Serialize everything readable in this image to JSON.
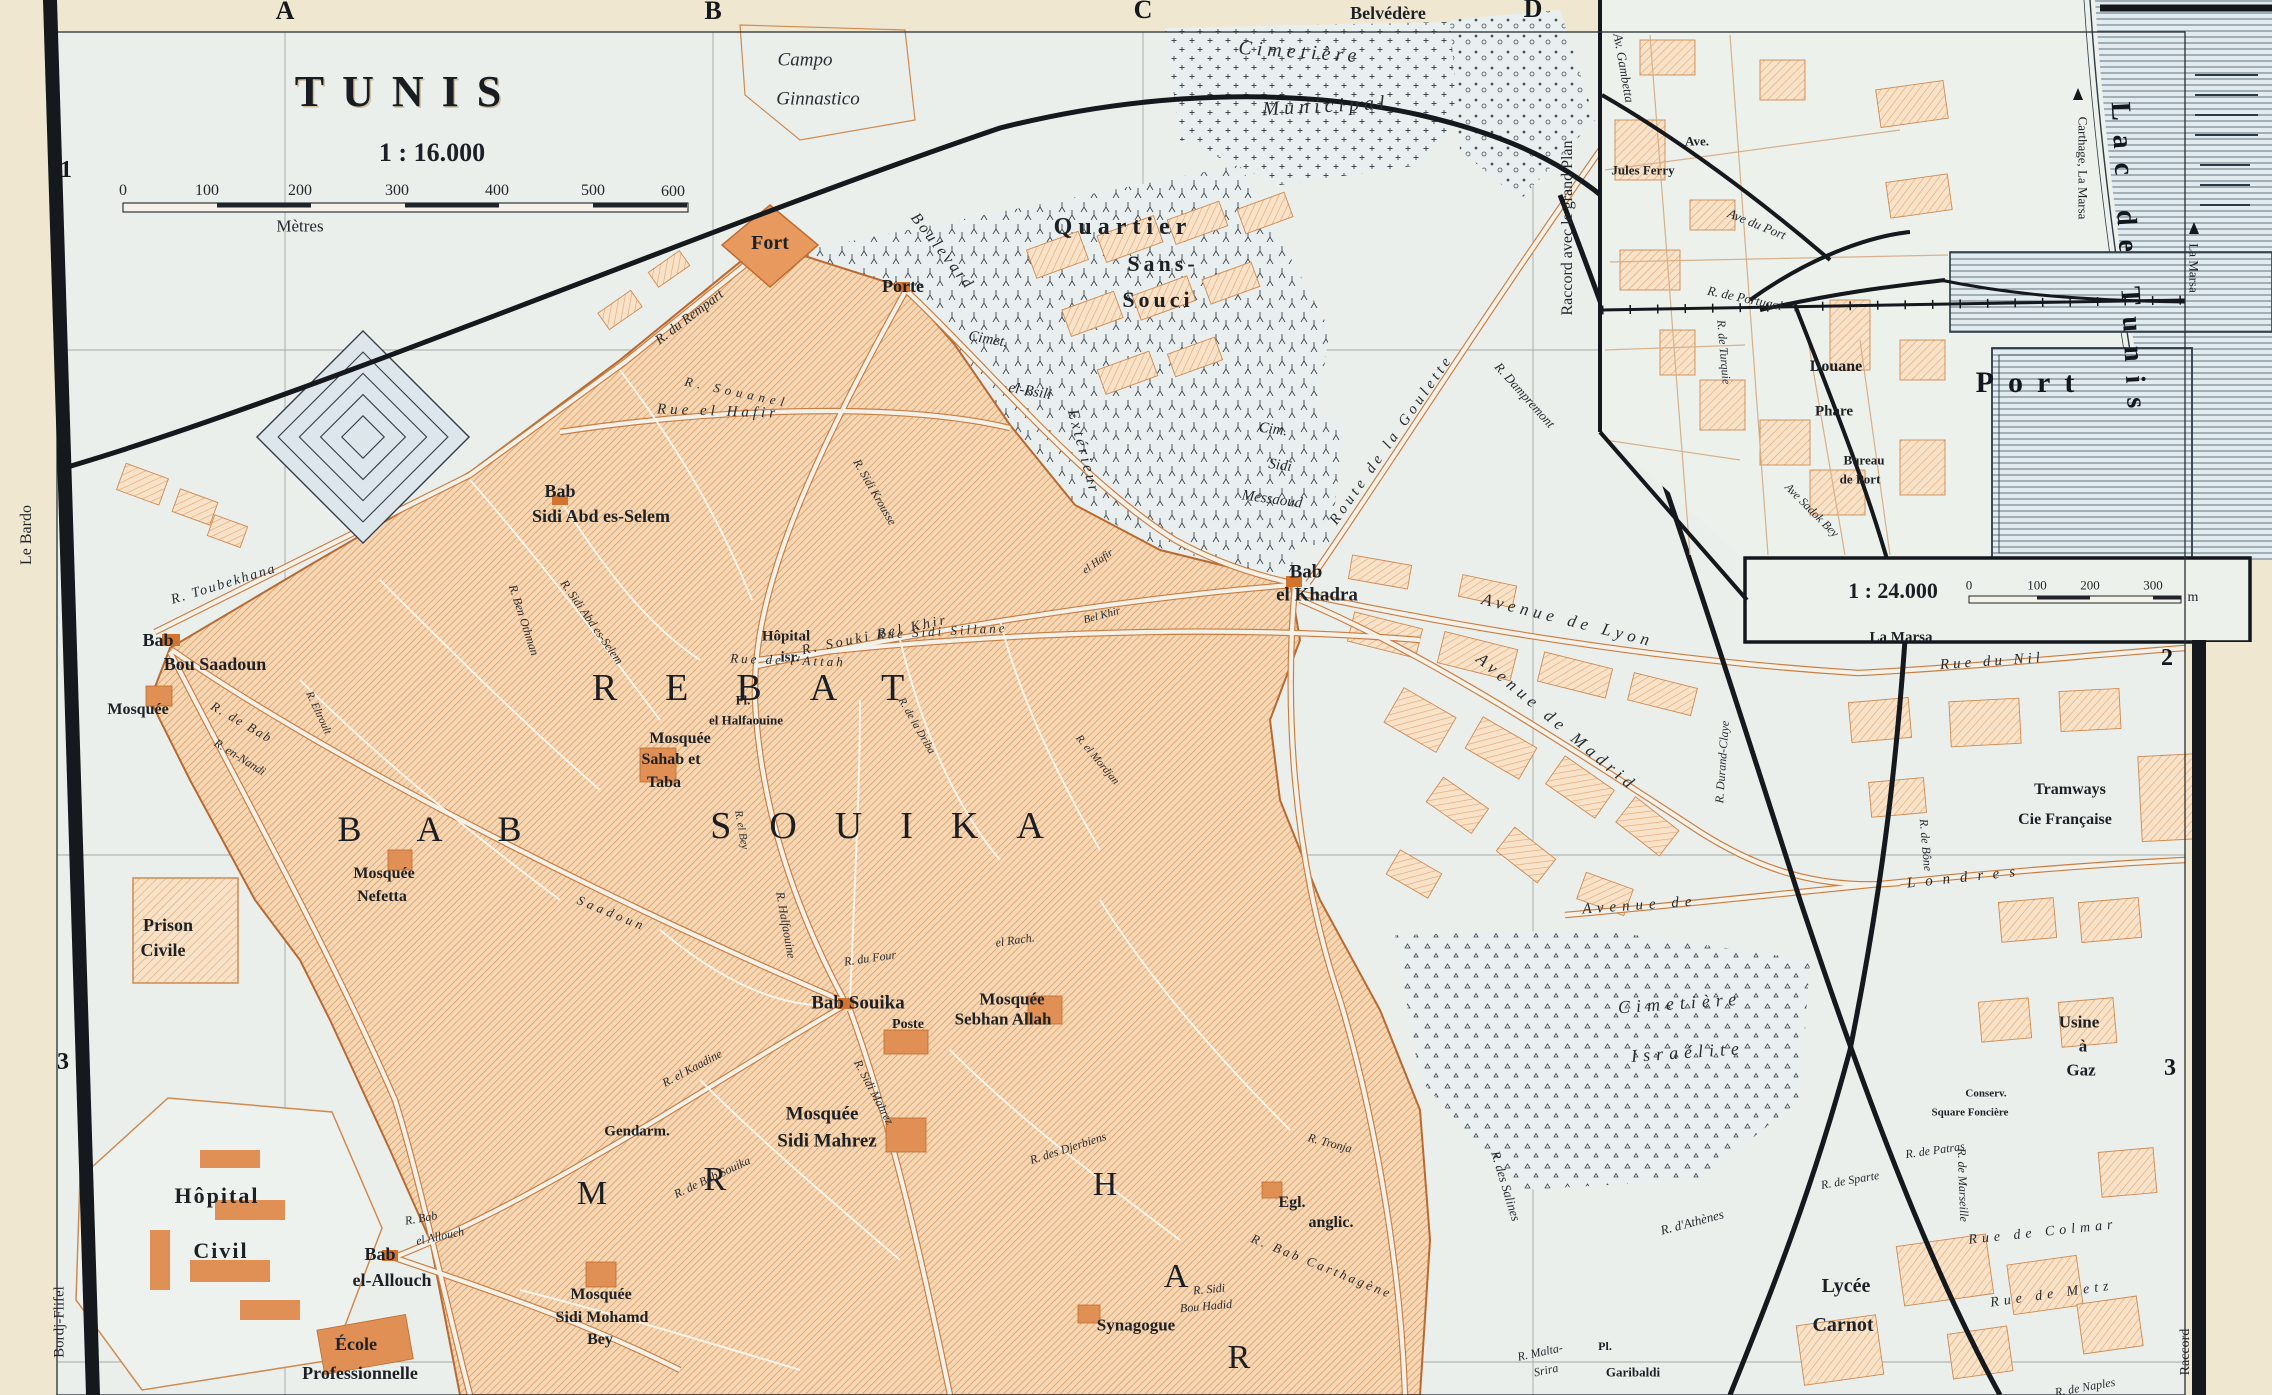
{
  "map": {
    "name": "Plan of Tunis (Baedeker style city map)",
    "main_scale": "1 : 16.000",
    "main_scale_unit": "Mètres",
    "inset_scale": "1 : 24.000",
    "inset_scale_unit": "m"
  },
  "colors": {
    "paper": "#f0e7d1",
    "map_background": "#ebefec",
    "built_area": "#f5d7b4",
    "built_hatch": "#dd9560",
    "building_solid": "#e09055",
    "road_casing": "#c97d42",
    "ink": "#1c2025",
    "water_line": "#2c3a46",
    "water_fill": "#e2ebee"
  },
  "grid": {
    "columns": [
      "A",
      "B",
      "C",
      "D"
    ],
    "rows_left": [
      "1",
      "2",
      "3"
    ],
    "rows_right": [
      "2",
      "3"
    ]
  },
  "labels": [
    {
      "t": "A",
      "x": 285,
      "y": 11,
      "s": 26,
      "c": "grid"
    },
    {
      "t": "B",
      "x": 713,
      "y": 11,
      "s": 26,
      "c": "grid"
    },
    {
      "t": "C",
      "x": 1143,
      "y": 10,
      "s": 26,
      "c": "grid"
    },
    {
      "t": "D",
      "x": 1533,
      "y": 9,
      "s": 26,
      "c": "grid"
    },
    {
      "t": "1",
      "x": 66,
      "y": 170,
      "s": 24,
      "c": "grid"
    },
    {
      "t": "2",
      "x": 70,
      "y": 637,
      "s": 24,
      "c": "grid"
    },
    {
      "t": "3",
      "x": 63,
      "y": 1062,
      "s": 24,
      "c": "grid"
    },
    {
      "t": "2",
      "x": 2167,
      "y": 658,
      "s": 24,
      "c": "grid"
    },
    {
      "t": "3",
      "x": 2170,
      "y": 1068,
      "s": 24,
      "c": "grid"
    },
    {
      "t": "Le Bardo",
      "x": 27,
      "y": 535,
      "r": -90,
      "s": 16,
      "c": "margin"
    },
    {
      "t": "Bordj-Flifel",
      "x": 60,
      "y": 1322,
      "r": -90,
      "s": 15,
      "c": "margin"
    },
    {
      "t": "TUNIS",
      "x": 407,
      "y": 92,
      "s": 44,
      "c": "title",
      "ls": 18
    },
    {
      "t": "1 : 16.000",
      "x": 432,
      "y": 153,
      "s": 26,
      "c": "sub"
    },
    {
      "t": "0",
      "x": 123,
      "y": 191,
      "s": 16,
      "c": "num"
    },
    {
      "t": "100",
      "x": 207,
      "y": 191,
      "s": 16,
      "c": "num"
    },
    {
      "t": "200",
      "x": 300,
      "y": 191,
      "s": 16,
      "c": "num"
    },
    {
      "t": "300",
      "x": 397,
      "y": 191,
      "s": 16,
      "c": "num"
    },
    {
      "t": "400",
      "x": 497,
      "y": 191,
      "s": 16,
      "c": "num"
    },
    {
      "t": "500",
      "x": 593,
      "y": 191,
      "s": 16,
      "c": "num"
    },
    {
      "t": "600",
      "x": 673,
      "y": 192,
      "s": 16,
      "c": "num"
    },
    {
      "t": "Mètres",
      "x": 300,
      "y": 226,
      "s": 17,
      "c": "num"
    },
    {
      "t": "Campo",
      "x": 805,
      "y": 60,
      "s": 19,
      "c": "ital"
    },
    {
      "t": "Ginnastico",
      "x": 818,
      "y": 99,
      "s": 19,
      "c": "ital"
    },
    {
      "t": "Fort",
      "x": 770,
      "y": 243,
      "s": 20,
      "c": "place"
    },
    {
      "t": "Porte",
      "x": 903,
      "y": 286,
      "s": 18,
      "c": "place"
    },
    {
      "t": "Quartier",
      "x": 1123,
      "y": 227,
      "s": 24,
      "c": "place",
      "ls": 6
    },
    {
      "t": "Sans-",
      "x": 1163,
      "y": 264,
      "s": 22,
      "c": "place",
      "ls": 4
    },
    {
      "t": "Souci",
      "x": 1158,
      "y": 300,
      "s": 22,
      "c": "place",
      "ls": 4
    },
    {
      "t": "Boulevard",
      "x": 942,
      "y": 252,
      "r": 52,
      "s": 16,
      "c": "street",
      "ls": 3
    },
    {
      "t": "Extérieur",
      "x": 1083,
      "y": 452,
      "r": 75,
      "s": 16,
      "c": "street",
      "ls": 3
    },
    {
      "t": "Cimet.",
      "x": 988,
      "y": 340,
      "r": 10,
      "s": 15,
      "c": "street"
    },
    {
      "t": "el-Bsili",
      "x": 1030,
      "y": 392,
      "r": 10,
      "s": 15,
      "c": "street"
    },
    {
      "t": "Cimetière",
      "x": 1300,
      "y": 52,
      "r": 4,
      "s": 20,
      "c": "ital",
      "ls": 5
    },
    {
      "t": "Municipal",
      "x": 1326,
      "y": 106,
      "r": -3,
      "s": 20,
      "c": "ital",
      "ls": 5
    },
    {
      "t": "Belvédère",
      "x": 1388,
      "y": 13,
      "s": 18,
      "c": "place"
    },
    {
      "t": "Cim.",
      "x": 1273,
      "y": 430,
      "r": 8,
      "s": 15,
      "c": "street"
    },
    {
      "t": "Sidi",
      "x": 1280,
      "y": 466,
      "r": 8,
      "s": 15,
      "c": "street"
    },
    {
      "t": "Messaoud",
      "x": 1272,
      "y": 500,
      "r": 8,
      "s": 15,
      "c": "street"
    },
    {
      "t": "Route de la Goulette",
      "x": 1392,
      "y": 440,
      "r": -55,
      "s": 15,
      "c": "street",
      "ls": 4
    },
    {
      "t": "R. Dampremont",
      "x": 1525,
      "y": 395,
      "r": 48,
      "s": 13,
      "c": "street"
    },
    {
      "t": "Raccord avec le grand Plan",
      "x": 1568,
      "y": 228,
      "r": -90,
      "s": 16,
      "c": "margin"
    },
    {
      "t": "R. du Rempart",
      "x": 690,
      "y": 318,
      "r": -37,
      "s": 14,
      "c": "street"
    },
    {
      "t": "R. Souanel",
      "x": 737,
      "y": 392,
      "r": 12,
      "s": 13,
      "c": "street",
      "ls": 5
    },
    {
      "t": "Bab",
      "x": 560,
      "y": 491,
      "s": 18,
      "c": "place"
    },
    {
      "t": "Sidi Abd es-Selem",
      "x": 601,
      "y": 516,
      "s": 18,
      "c": "place"
    },
    {
      "t": "Bab",
      "x": 158,
      "y": 640,
      "s": 18,
      "c": "place"
    },
    {
      "t": "Bou Saadoun",
      "x": 215,
      "y": 664,
      "s": 18,
      "c": "place"
    },
    {
      "t": "Mosquée",
      "x": 138,
      "y": 710,
      "s": 16,
      "c": "place"
    },
    {
      "t": "R. Toubekhana",
      "x": 224,
      "y": 585,
      "r": -17,
      "s": 14,
      "c": "street",
      "ls": 2
    },
    {
      "t": "R. de Bab",
      "x": 242,
      "y": 722,
      "r": 30,
      "s": 13,
      "c": "street",
      "ls": 2
    },
    {
      "t": "Saadoun",
      "x": 612,
      "y": 913,
      "r": 22,
      "s": 13,
      "c": "street",
      "ls": 4
    },
    {
      "t": "R. Ben Othman",
      "x": 524,
      "y": 620,
      "r": 72,
      "s": 12,
      "c": "street"
    },
    {
      "t": "R. Sidi Abd es-Selem",
      "x": 592,
      "y": 622,
      "r": 55,
      "s": 12,
      "c": "street"
    },
    {
      "t": "R. en-Nandi",
      "x": 240,
      "y": 757,
      "r": 32,
      "s": 12,
      "c": "street"
    },
    {
      "t": "R. Eltroult",
      "x": 318,
      "y": 713,
      "r": 65,
      "s": 11,
      "c": "street"
    },
    {
      "t": "Rue el Hafir",
      "x": 718,
      "y": 412,
      "r": 2,
      "s": 15,
      "c": "street",
      "ls": 4
    },
    {
      "t": "R. Souki Bel Khir",
      "x": 875,
      "y": 636,
      "r": -12,
      "s": 14,
      "c": "street",
      "ls": 3
    },
    {
      "t": "el Hafir",
      "x": 1098,
      "y": 562,
      "r": -35,
      "s": 11,
      "c": "street"
    },
    {
      "t": "Bel Khir",
      "x": 1102,
      "y": 616,
      "r": -15,
      "s": 11,
      "c": "street"
    },
    {
      "t": "R. Sidi Krousse",
      "x": 875,
      "y": 492,
      "r": 60,
      "s": 12,
      "c": "street"
    },
    {
      "t": "Hôpital",
      "x": 786,
      "y": 637,
      "s": 15,
      "c": "place"
    },
    {
      "t": "isr.",
      "x": 790,
      "y": 658,
      "s": 15,
      "c": "place"
    },
    {
      "t": "Pl.",
      "x": 743,
      "y": 700,
      "s": 13,
      "c": "place"
    },
    {
      "t": "el Halfaouine",
      "x": 746,
      "y": 720,
      "s": 13,
      "c": "place"
    },
    {
      "t": "Mosquée",
      "x": 680,
      "y": 739,
      "s": 16,
      "c": "place"
    },
    {
      "t": "Sahab et",
      "x": 671,
      "y": 760,
      "s": 16,
      "c": "place"
    },
    {
      "t": "Taba",
      "x": 664,
      "y": 783,
      "s": 16,
      "c": "place"
    },
    {
      "t": "R. el Bey",
      "x": 741,
      "y": 830,
      "r": 80,
      "s": 11,
      "c": "street"
    },
    {
      "t": "R. de la Driba",
      "x": 916,
      "y": 726,
      "r": 60,
      "s": 11,
      "c": "street"
    },
    {
      "t": "R. el Mordjan",
      "x": 1097,
      "y": 760,
      "r": 50,
      "s": 11,
      "c": "street"
    },
    {
      "t": "Mosquée",
      "x": 384,
      "y": 874,
      "s": 16,
      "c": "place"
    },
    {
      "t": "Nefetta",
      "x": 382,
      "y": 897,
      "s": 16,
      "c": "place"
    },
    {
      "t": "REBAT",
      "x": 772,
      "y": 688,
      "s": 38,
      "c": "dist",
      "ls": 48
    },
    {
      "t": "BAB",
      "x": 457,
      "y": 829,
      "s": 36,
      "c": "dist",
      "ls": 55
    },
    {
      "t": "SOUIKA",
      "x": 896,
      "y": 826,
      "s": 38,
      "c": "dist",
      "ls": 38
    },
    {
      "t": "H",
      "x": 1105,
      "y": 1185,
      "s": 34,
      "c": "dist"
    },
    {
      "t": "A",
      "x": 1176,
      "y": 1277,
      "s": 34,
      "c": "dist"
    },
    {
      "t": "R",
      "x": 1239,
      "y": 1358,
      "s": 34,
      "c": "dist"
    },
    {
      "t": "M",
      "x": 592,
      "y": 1194,
      "s": 34,
      "c": "dist"
    },
    {
      "t": "R",
      "x": 715,
      "y": 1180,
      "s": 34,
      "c": "dist"
    },
    {
      "t": "Bab Souika",
      "x": 858,
      "y": 1003,
      "s": 19,
      "c": "place"
    },
    {
      "t": "Poste",
      "x": 908,
      "y": 1025,
      "s": 14,
      "c": "place"
    },
    {
      "t": "Mosquée",
      "x": 1012,
      "y": 999,
      "s": 17,
      "c": "place"
    },
    {
      "t": "Sebhan Allah",
      "x": 1003,
      "y": 1019,
      "s": 17,
      "c": "place"
    },
    {
      "t": "Gendarm.",
      "x": 637,
      "y": 1132,
      "s": 15,
      "c": "place"
    },
    {
      "t": "Mosquée",
      "x": 822,
      "y": 1114,
      "s": 19,
      "c": "place"
    },
    {
      "t": "Sidi Mahrez",
      "x": 827,
      "y": 1141,
      "s": 19,
      "c": "place"
    },
    {
      "t": "R. Sidi Mahrez",
      "x": 874,
      "y": 1092,
      "r": 62,
      "s": 12,
      "c": "street"
    },
    {
      "t": "R. el Kaadine",
      "x": 692,
      "y": 1068,
      "r": -28,
      "s": 12,
      "c": "street"
    },
    {
      "t": "R. de Bab Souika",
      "x": 712,
      "y": 1177,
      "r": -25,
      "s": 12,
      "c": "street"
    },
    {
      "t": "R. Halfaouine",
      "x": 786,
      "y": 925,
      "r": 80,
      "s": 12,
      "c": "street"
    },
    {
      "t": "R. du Four",
      "x": 870,
      "y": 958,
      "r": -8,
      "s": 12,
      "c": "street"
    },
    {
      "t": "el Rach.",
      "x": 1015,
      "y": 940,
      "r": -8,
      "s": 12,
      "c": "street"
    },
    {
      "t": "Prison",
      "x": 168,
      "y": 925,
      "s": 18,
      "c": "place"
    },
    {
      "t": "Civile",
      "x": 163,
      "y": 950,
      "s": 18,
      "c": "place"
    },
    {
      "t": "Hôpital",
      "x": 217,
      "y": 1196,
      "s": 22,
      "c": "place",
      "ls": 2
    },
    {
      "t": "Civil",
      "x": 221,
      "y": 1251,
      "s": 22,
      "c": "place",
      "ls": 2
    },
    {
      "t": "Bab",
      "x": 380,
      "y": 1254,
      "s": 18,
      "c": "place"
    },
    {
      "t": "el-Allouch",
      "x": 392,
      "y": 1280,
      "s": 18,
      "c": "place"
    },
    {
      "t": "R. Bab",
      "x": 421,
      "y": 1218,
      "r": -10,
      "s": 12,
      "c": "street"
    },
    {
      "t": "el Allouch",
      "x": 440,
      "y": 1236,
      "r": -12,
      "s": 12,
      "c": "street"
    },
    {
      "t": "École",
      "x": 356,
      "y": 1344,
      "s": 18,
      "c": "place"
    },
    {
      "t": "Professionnelle",
      "x": 360,
      "y": 1373,
      "s": 18,
      "c": "place"
    },
    {
      "t": "Mosquée",
      "x": 601,
      "y": 1295,
      "s": 16,
      "c": "place"
    },
    {
      "t": "Sidi Mohamd",
      "x": 602,
      "y": 1318,
      "s": 16,
      "c": "place"
    },
    {
      "t": "Bey",
      "x": 600,
      "y": 1340,
      "s": 16,
      "c": "place"
    },
    {
      "t": "Synagogue",
      "x": 1136,
      "y": 1325,
      "s": 17,
      "c": "place"
    },
    {
      "t": "R. Sidi",
      "x": 1209,
      "y": 1289,
      "r": -5,
      "s": 12,
      "c": "street"
    },
    {
      "t": "Bou Hadid",
      "x": 1206,
      "y": 1306,
      "r": -5,
      "s": 12,
      "c": "street"
    },
    {
      "t": "Egl.",
      "x": 1292,
      "y": 1203,
      "s": 16,
      "c": "place"
    },
    {
      "t": "anglic.",
      "x": 1331,
      "y": 1223,
      "s": 16,
      "c": "place"
    },
    {
      "t": "R. des Djerbiens",
      "x": 1068,
      "y": 1148,
      "r": -18,
      "s": 12,
      "c": "street"
    },
    {
      "t": "R. Bab Carthagène",
      "x": 1322,
      "y": 1266,
      "r": 22,
      "s": 13,
      "c": "street",
      "ls": 3
    },
    {
      "t": "R. Tronja",
      "x": 1330,
      "y": 1143,
      "r": 15,
      "s": 12,
      "c": "street"
    },
    {
      "t": "R. des Salines",
      "x": 1506,
      "y": 1186,
      "r": 73,
      "s": 13,
      "c": "street"
    },
    {
      "t": "R. Malta-",
      "x": 1540,
      "y": 1352,
      "r": -12,
      "s": 12,
      "c": "street"
    },
    {
      "t": "Srira",
      "x": 1546,
      "y": 1370,
      "r": -12,
      "s": 12,
      "c": "street"
    },
    {
      "t": "Pl.",
      "x": 1605,
      "y": 1346,
      "s": 12,
      "c": "place"
    },
    {
      "t": "Garibaldi",
      "x": 1633,
      "y": 1372,
      "s": 13,
      "c": "place"
    },
    {
      "t": "R. d'Athènes",
      "x": 1692,
      "y": 1222,
      "r": -15,
      "s": 13,
      "c": "street"
    },
    {
      "t": "Bab",
      "x": 1306,
      "y": 572,
      "s": 19,
      "c": "place"
    },
    {
      "t": "el Khadra",
      "x": 1317,
      "y": 595,
      "s": 19,
      "c": "place"
    },
    {
      "t": "Avenue de Lyon",
      "x": 1568,
      "y": 620,
      "r": 14,
      "s": 17,
      "c": "street",
      "ls": 5
    },
    {
      "t": "Avenue de Madrid",
      "x": 1557,
      "y": 722,
      "r": 40,
      "s": 17,
      "c": "street",
      "ls": 5
    },
    {
      "t": "R. Durand-Claye",
      "x": 1722,
      "y": 762,
      "r": -86,
      "s": 12,
      "c": "street"
    },
    {
      "t": "Rue Sidi Sillane",
      "x": 942,
      "y": 631,
      "r": -3,
      "s": 13,
      "c": "street",
      "ls": 3
    },
    {
      "t": "Rue de l'Attah",
      "x": 788,
      "y": 660,
      "r": 2,
      "s": 13,
      "c": "street",
      "ls": 3
    },
    {
      "t": "Avenue de",
      "x": 1640,
      "y": 906,
      "r": -4,
      "s": 15,
      "c": "street",
      "ls": 6
    },
    {
      "t": "Londres",
      "x": 1966,
      "y": 878,
      "r": -6,
      "s": 15,
      "c": "street",
      "ls": 10
    },
    {
      "t": "Cimetière",
      "x": 1680,
      "y": 1003,
      "r": -4,
      "s": 18,
      "c": "ital",
      "ls": 6
    },
    {
      "t": "Israélite",
      "x": 1688,
      "y": 1052,
      "r": -4,
      "s": 18,
      "c": "ital",
      "ls": 6
    },
    {
      "t": "Tramways",
      "x": 2070,
      "y": 790,
      "s": 16,
      "c": "place"
    },
    {
      "t": "Cie Française",
      "x": 2065,
      "y": 820,
      "s": 16,
      "c": "place"
    },
    {
      "t": "Usine",
      "x": 2079,
      "y": 1022,
      "s": 17,
      "c": "place"
    },
    {
      "t": "à",
      "x": 2083,
      "y": 1046,
      "s": 17,
      "c": "place"
    },
    {
      "t": "Gaz",
      "x": 2081,
      "y": 1070,
      "s": 17,
      "c": "place"
    },
    {
      "t": "Conserv.",
      "x": 1986,
      "y": 1094,
      "s": 11,
      "c": "place"
    },
    {
      "t": "Square Foncière",
      "x": 1970,
      "y": 1113,
      "s": 11,
      "c": "place"
    },
    {
      "t": "R. de Sparte",
      "x": 1850,
      "y": 1180,
      "r": -10,
      "s": 12,
      "c": "street"
    },
    {
      "t": "R. de Patras",
      "x": 1935,
      "y": 1150,
      "r": -8,
      "s": 12,
      "c": "street"
    },
    {
      "t": "R. de Marseille",
      "x": 1963,
      "y": 1185,
      "r": 88,
      "s": 12,
      "c": "street"
    },
    {
      "t": "Rue de Colmar",
      "x": 2043,
      "y": 1233,
      "r": -6,
      "s": 14,
      "c": "street",
      "ls": 5
    },
    {
      "t": "Rue de Metz",
      "x": 2052,
      "y": 1295,
      "r": -8,
      "s": 14,
      "c": "street",
      "ls": 5
    },
    {
      "t": "R. de Naples",
      "x": 2085,
      "y": 1387,
      "r": -10,
      "s": 12,
      "c": "street"
    },
    {
      "t": "Lycée",
      "x": 1846,
      "y": 1286,
      "s": 20,
      "c": "place"
    },
    {
      "t": "Carnot",
      "x": 1843,
      "y": 1325,
      "s": 20,
      "c": "place"
    },
    {
      "t": "R. de Bône",
      "x": 1926,
      "y": 845,
      "r": 85,
      "s": 12,
      "c": "street"
    },
    {
      "t": "Raccord",
      "x": 2186,
      "y": 1352,
      "r": -90,
      "s": 14,
      "c": "margin"
    },
    {
      "t": "Rue du Nil",
      "x": 1992,
      "y": 662,
      "r": -4,
      "s": 15,
      "c": "street",
      "ls": 4
    },
    {
      "t": "La Marsa",
      "x": 1901,
      "y": 638,
      "s": 15,
      "c": "place"
    },
    {
      "t": "Av. Gambetta",
      "x": 1624,
      "y": 68,
      "r": 80,
      "s": 13,
      "c": "street"
    },
    {
      "t": "Ave.",
      "x": 1697,
      "y": 141,
      "s": 13,
      "c": "place"
    },
    {
      "t": "Jules Ferry",
      "x": 1643,
      "y": 170,
      "s": 13,
      "c": "place"
    },
    {
      "t": "Ave du Port",
      "x": 1757,
      "y": 224,
      "r": 22,
      "s": 13,
      "c": "street"
    },
    {
      "t": "R. de Portugal",
      "x": 1745,
      "y": 298,
      "r": 12,
      "s": 13,
      "c": "street"
    },
    {
      "t": "R. de Turquie",
      "x": 1724,
      "y": 352,
      "r": 85,
      "s": 12,
      "c": "street"
    },
    {
      "t": "Douane",
      "x": 1836,
      "y": 367,
      "s": 16,
      "c": "place"
    },
    {
      "t": "Phare",
      "x": 1834,
      "y": 412,
      "s": 15,
      "c": "place"
    },
    {
      "t": "Bureau",
      "x": 1864,
      "y": 460,
      "s": 13,
      "c": "place"
    },
    {
      "t": "de Port",
      "x": 1860,
      "y": 479,
      "s": 13,
      "c": "place"
    },
    {
      "t": "Ave Sadok Bey",
      "x": 1812,
      "y": 510,
      "r": 45,
      "s": 12,
      "c": "street"
    },
    {
      "t": "Port",
      "x": 2032,
      "y": 383,
      "s": 30,
      "c": "water",
      "ls": 14
    },
    {
      "t": "Lac de Tunis",
      "x": 2128,
      "y": 262,
      "r": 87,
      "s": 28,
      "c": "water",
      "ls": 14
    },
    {
      "t": "Carthage, La Marsa",
      "x": 2083,
      "y": 168,
      "r": 90,
      "s": 13,
      "c": "margin"
    },
    {
      "t": "La Marsa",
      "x": 2194,
      "y": 268,
      "r": 90,
      "s": 13,
      "c": "margin"
    },
    {
      "t": "1 : 24.000",
      "x": 1893,
      "y": 591,
      "s": 22,
      "c": "sub"
    },
    {
      "t": "0",
      "x": 1969,
      "y": 585,
      "s": 13,
      "c": "num"
    },
    {
      "t": "100",
      "x": 2037,
      "y": 585,
      "s": 13,
      "c": "num"
    },
    {
      "t": "200",
      "x": 2090,
      "y": 585,
      "s": 13,
      "c": "num"
    },
    {
      "t": "300",
      "x": 2153,
      "y": 585,
      "s": 13,
      "c": "num"
    },
    {
      "t": "m",
      "x": 2193,
      "y": 598,
      "s": 14,
      "c": "num"
    }
  ]
}
